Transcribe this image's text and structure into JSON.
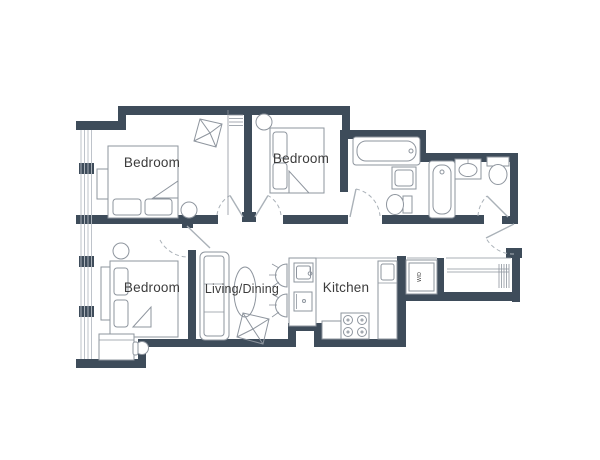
{
  "floorplan": {
    "background": "#ffffff",
    "colors": {
      "wall": "#3e4c5a",
      "furniture": "#8e959e",
      "door": "#aab1b8",
      "window": "#b7bdc4",
      "text": "#3c3c3c"
    },
    "rooms": [
      {
        "id": "bedroom-1",
        "label": "Bedroom"
      },
      {
        "id": "bedroom-2",
        "label": "Bedroom"
      },
      {
        "id": "bedroom-3",
        "label": "Bedroom"
      },
      {
        "id": "living-dining",
        "label": "Living/Dining"
      },
      {
        "id": "kitchen",
        "label": "Kitchen"
      },
      {
        "id": "laundry-closet",
        "label": "W/D"
      }
    ]
  }
}
